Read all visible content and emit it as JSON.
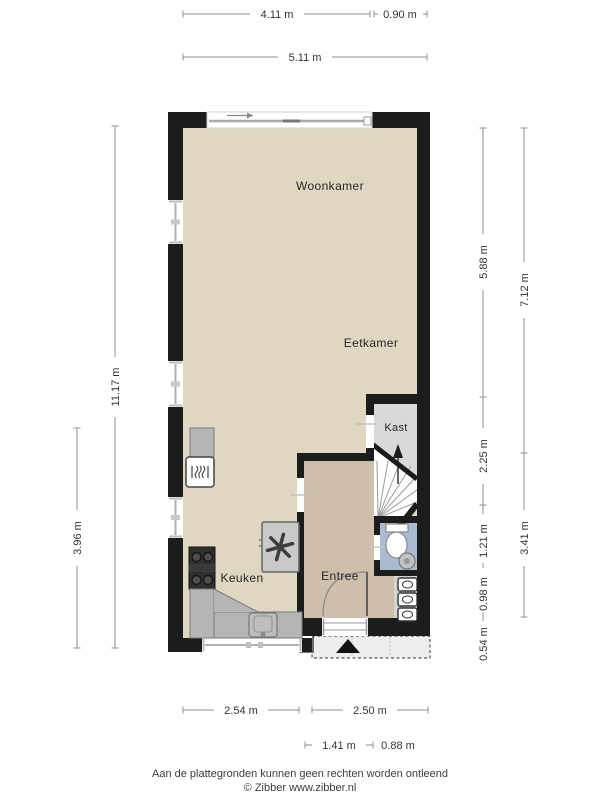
{
  "plan": {
    "rooms": {
      "woonkamer": "Woonkamer",
      "eetkamer": "Eetkamer",
      "kast": "Kast",
      "keuken": "Keuken",
      "entree": "Entree"
    },
    "dims": {
      "top1": "4.11 m",
      "top2": "0.90 m",
      "top3": "5.11 m",
      "left1": "11.17 m",
      "left2": "3.96 m",
      "right_inner1": "5.88 m",
      "right_inner2": "2.25 m",
      "right_inner3": "1.21 m",
      "right_inner4": "0.98 m",
      "right_inner5": "0.54 m",
      "right_outer1": "7.12 m",
      "right_outer2": "3.41 m",
      "bottom1": "2.54 m",
      "bottom2": "2.50 m",
      "bottom3": "1.41 m",
      "bottom4": "0.88 m"
    },
    "footer": {
      "line1": "Aan de plattegronden kunnen geen rechten worden ontleend",
      "line2": "© Zibber www.zibber.nl"
    },
    "icons": {
      "slide_arrow": "sliding-door-direction-arrow",
      "stairs_arrow": "stairs-up-arrow",
      "entrance_arrow": "entrance-triangle-arrow",
      "fan": "mechanical-ventilation-fan",
      "stove": "cooktop-4-burners",
      "oven": "oven-steam",
      "sink": "kitchen-sink",
      "toilet": "toilet",
      "washbasin": "round-washbasin",
      "installations": "utility-appliance-boxes"
    },
    "colors": {
      "wall": "#1c1c1c",
      "floor_main": "#e0d7c2",
      "floor_entree": "#cdbfab",
      "floor_kast": "#d9d9d9",
      "floor_toilet": "#a9bad1",
      "counter": "#b5b5b5",
      "dimension": "#8f8f8f",
      "text": "#333333"
    }
  }
}
